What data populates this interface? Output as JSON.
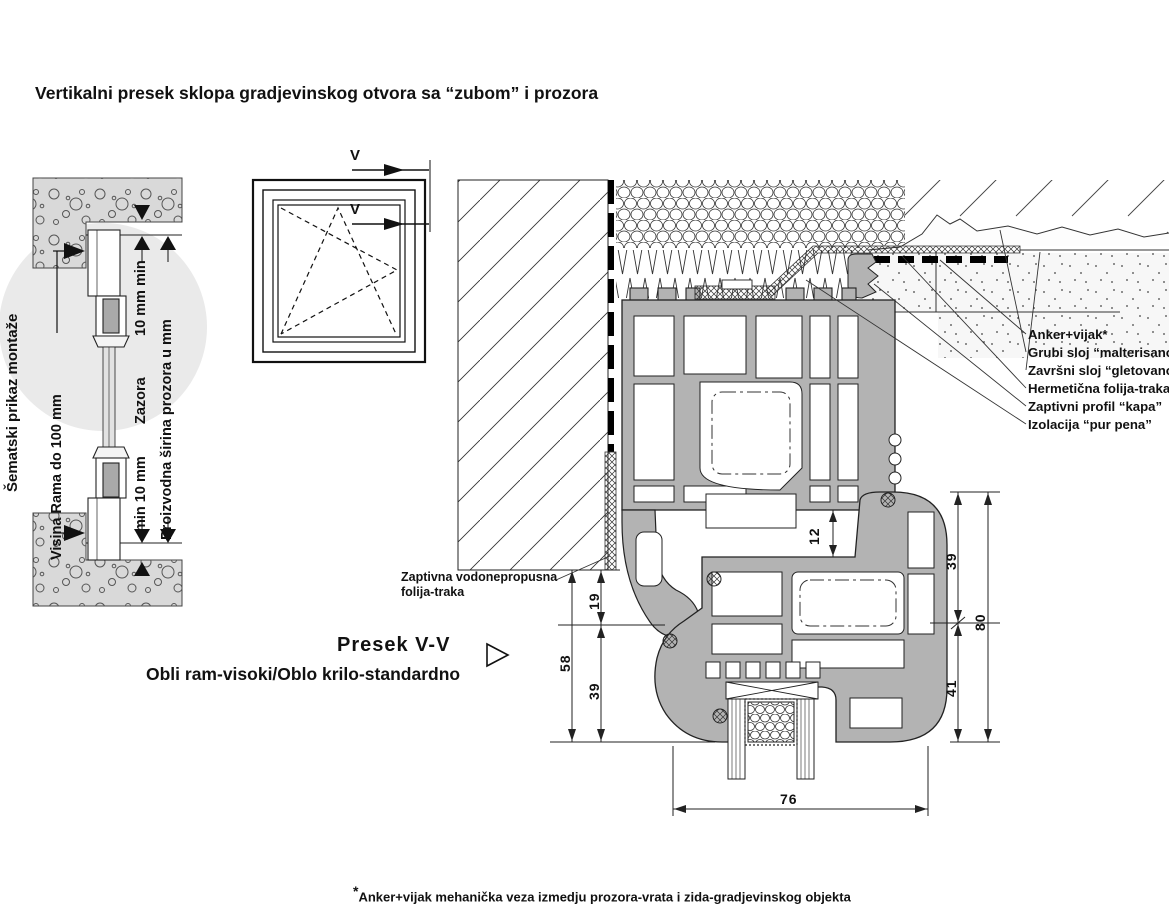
{
  "title": "Vertikalni presek sklopa gradjevinskog otvora sa “zubom” i prozora",
  "schematic": {
    "label_side": "Šematski prikaz montaže",
    "label_frame_height": "Visina Rama do 100 mm",
    "label_gap_top": "10 mm min",
    "label_gap_middle": "Zazora",
    "label_gap_bottom": "min 10 mm",
    "label_production_width": "Proizvodna širina prozora u mm"
  },
  "section_marker": {
    "v_top": "V",
    "v_bottom": "V"
  },
  "section_title": {
    "line1": "Presek  V-V",
    "line2": "Obli ram-visoki/Oblo krilo-standardno"
  },
  "membrane_label": {
    "line1": "Zaptivna vodonepropusna",
    "line2": "folija-traka"
  },
  "callouts": [
    "Anker+vijak*",
    "Grubi sloj “malterisano”",
    "Završni sloj “gletovano”",
    "Hermetična folija-traka",
    "Zaptivni profil “kapa”",
    "Izolacija “pur pena”"
  ],
  "dimensions": {
    "sash_gap": "12",
    "left_top": "19",
    "left_bottom": "39",
    "left_total": "58",
    "right_top": "39",
    "right_bottom": "41",
    "right_total": "80",
    "width": "76"
  },
  "footnote": {
    "asterisk": "*",
    "text": "Anker+vijak mehanička veza izmedju prozora-vrata i zida-gradjevinskog objekta"
  },
  "colors": {
    "profile_gray": "#b3b3b3",
    "circle_gray": "#eaeaea",
    "concrete_gray": "#d9d9d9",
    "line_black": "#1a1a1a"
  }
}
